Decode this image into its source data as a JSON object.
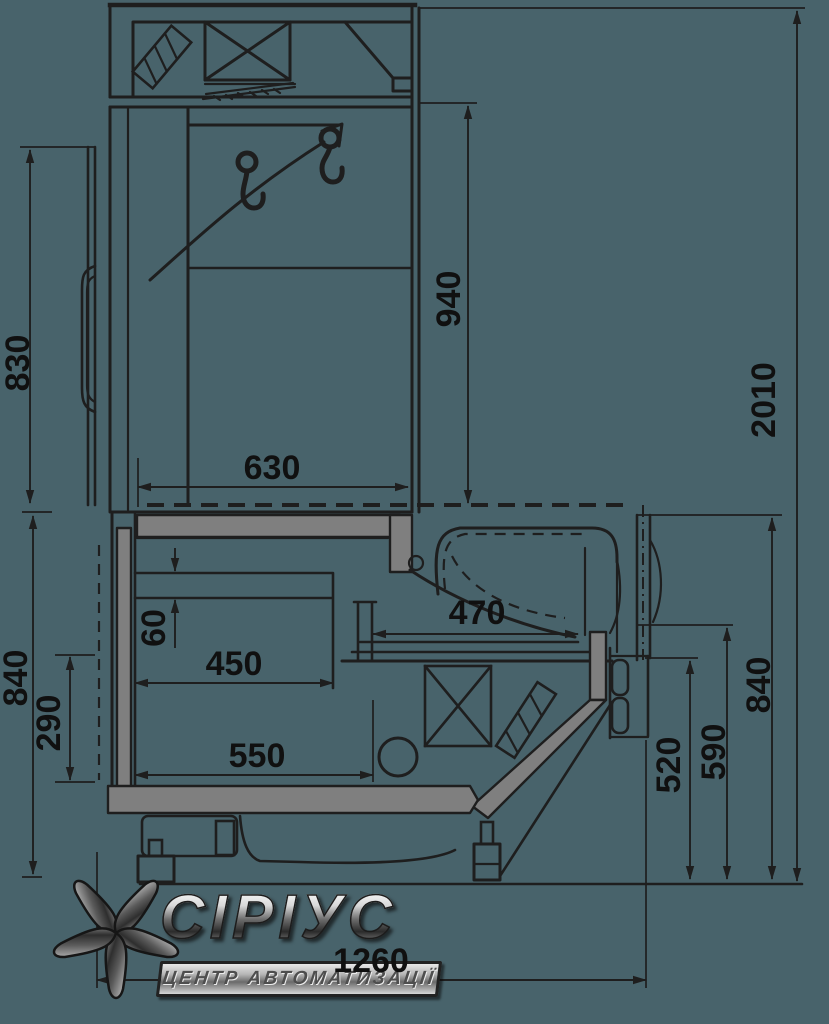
{
  "document": {
    "kind": "technical-section-drawing",
    "subject": "refrigerated serve-over display counter, side section",
    "units": "mm",
    "background_color": "#48636b",
    "line_color": "#1e1e1e",
    "panel_gray": "#7f7f7f"
  },
  "dimensions_mm": {
    "d830": "830",
    "d940": "940",
    "d2010": "2010",
    "d630": "630",
    "d470": "470",
    "d60": "60",
    "d450": "450",
    "d290": "290",
    "d840_left": "840",
    "d550": "550",
    "d520": "520",
    "d590": "590",
    "d840_right": "840",
    "d1260": "1260"
  },
  "logo": {
    "brand": "СІРІУС",
    "tagline": "ЦЕНТР АВТОМАТИЗАЦІЇ"
  }
}
